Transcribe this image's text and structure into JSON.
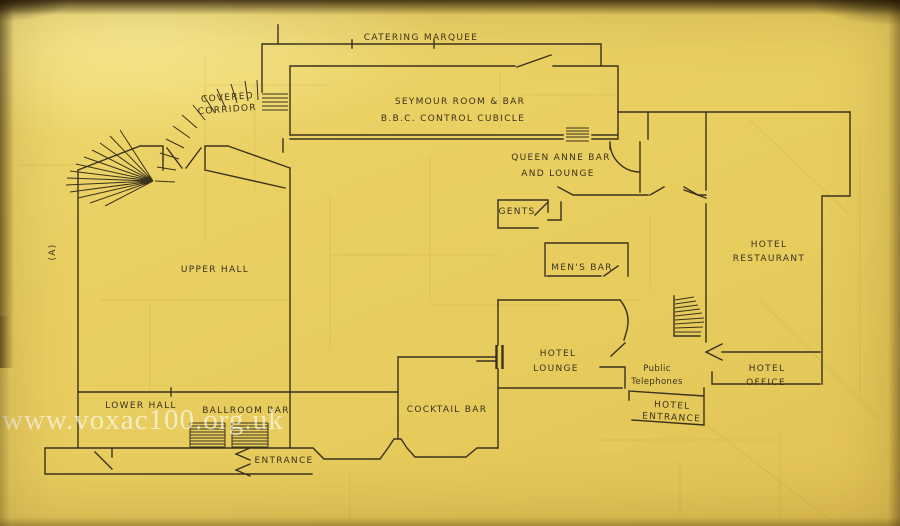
{
  "photo": {
    "watermark": "www.voxac100.org.uk",
    "paper_color": "#e8cd5f",
    "ink_color": "#3a321c"
  },
  "plan": {
    "figure_label": "(A)",
    "labels": {
      "catering_marquee": "CATERING MARQUEE",
      "covered_1": "COVERED",
      "covered_2": "CORRIDOR",
      "seymour_room": "SEYMOUR ROOM & BAR",
      "bbc_cubicle": "B.B.C. CONTROL CUBICLE",
      "queen_anne_1": "QUEEN ANNE BAR",
      "queen_anne_2": "AND LOUNGE",
      "gents": "GENTS",
      "mens_bar": "MEN'S BAR",
      "restaurant_1": "HOTEL",
      "restaurant_2": "RESTAURANT",
      "upper_hall": "UPPER HALL",
      "lower_hall": "LOWER HALL",
      "ballroom_bar": "BALLROOM BAR",
      "cocktail_bar": "COCKTAIL BAR",
      "lounge_1": "HOTEL",
      "lounge_2": "LOUNGE",
      "phones_1": "Public",
      "phones_2": "Telephones",
      "hotel_entrance_1": "HOTEL",
      "hotel_entrance_2": "ENTRANCE",
      "office_1": "HOTEL",
      "office_2": "OFFICE",
      "entrance": "ENTRANCE"
    }
  }
}
